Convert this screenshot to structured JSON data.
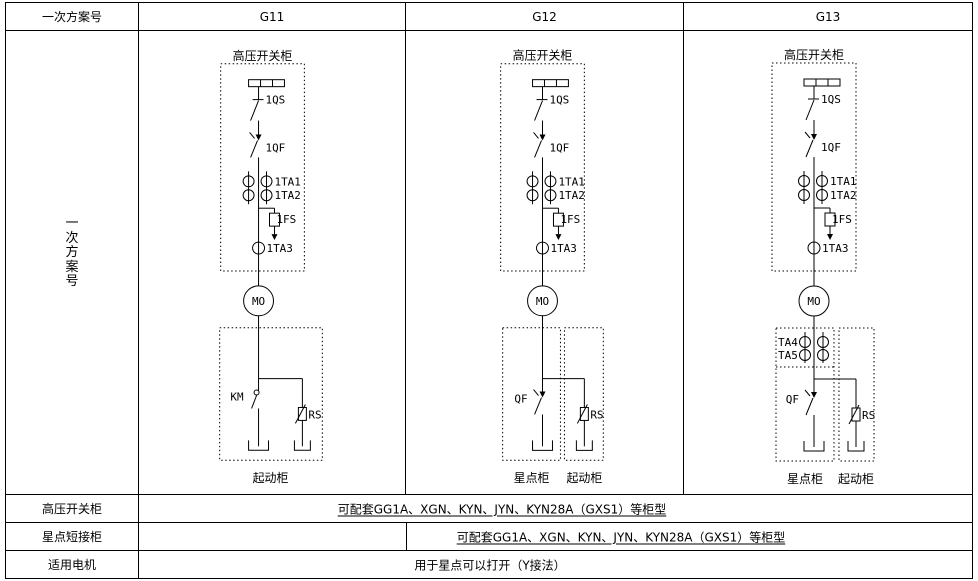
{
  "header": {
    "row_label": "一次方案号",
    "schemes": [
      "G11",
      "G12",
      "G13"
    ]
  },
  "side_label": "一次方案号",
  "hv": {
    "box_label": "高压开关柜",
    "qs": "1QS",
    "qf": "1QF",
    "ta1": "1TA1",
    "ta2": "1TA2",
    "fs": "1FS",
    "ta3": "1TA3",
    "motor": "MO"
  },
  "g11": {
    "contactor": "KM",
    "resistor": "RS",
    "start_box": "起动柜"
  },
  "g12": {
    "breaker": "QF",
    "resistor": "RS",
    "star_box": "星点柜",
    "start_box": "起动柜"
  },
  "g13": {
    "ta4": "TA4",
    "ta5": "TA5",
    "breaker": "QF",
    "resistor": "RS",
    "star_box": "星点柜",
    "start_box": "起动柜"
  },
  "info_rows": [
    {
      "label": "高压开关柜",
      "text": "可配套GG1A、XGN、KYN、JYN、KYN28A（GXS1）等柜型"
    },
    {
      "label": "星点短接柜",
      "text": "可配套GG1A、XGN、KYN、JYN、KYN28A（GXS1）等柜型"
    },
    {
      "label": "适用电机",
      "text": "用于星点可以打开（Y接法）"
    }
  ]
}
